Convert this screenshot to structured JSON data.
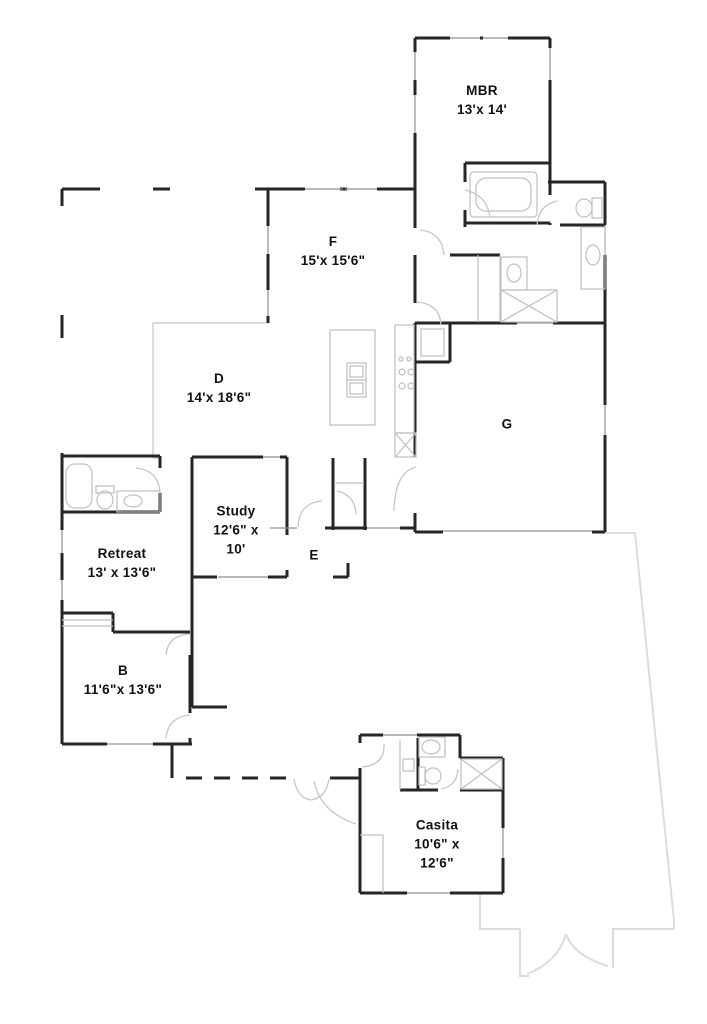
{
  "plan": {
    "title": "Single-story residence floor plan",
    "rooms": [
      {
        "id": "mbr",
        "name": "MBR",
        "dims": [
          "13'x 14'"
        ]
      },
      {
        "id": "f",
        "name": "F",
        "dims": [
          "15'x 15'6\""
        ]
      },
      {
        "id": "d",
        "name": "D",
        "dims": [
          "14'x 18'6\""
        ]
      },
      {
        "id": "g",
        "name": "G",
        "dims": []
      },
      {
        "id": "study",
        "name": "Study",
        "dims": [
          "12'6\" x",
          "10'"
        ]
      },
      {
        "id": "e",
        "name": "E",
        "dims": []
      },
      {
        "id": "retreat",
        "name": "Retreat",
        "dims": [
          "13' x 13'6\""
        ]
      },
      {
        "id": "b",
        "name": "B",
        "dims": [
          "11'6\"x 13'6\""
        ]
      },
      {
        "id": "casita",
        "name": "Casita",
        "dims": [
          "10'6\" x",
          "12'6\""
        ]
      }
    ],
    "colors": {
      "wall": "#262626",
      "window": "#8f8f8f",
      "fixture": "#bfbfbf",
      "door_swing": "#c6c6c6",
      "patio_outline": "#dcdcdc",
      "label": "#111111",
      "background": "#ffffff"
    }
  }
}
